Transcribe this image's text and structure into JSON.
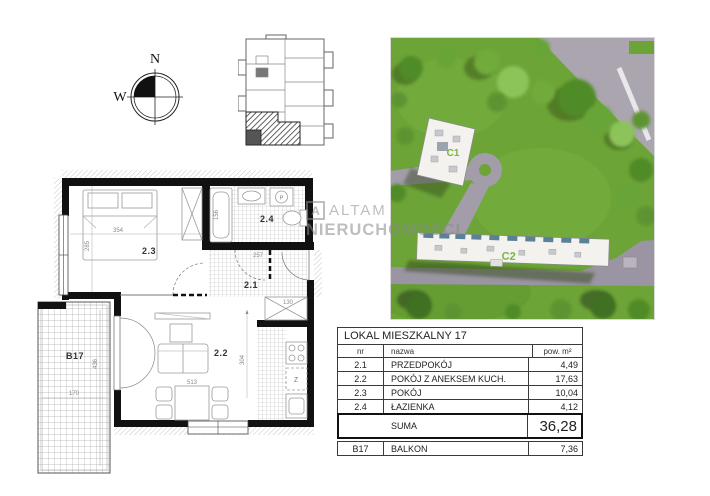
{
  "compass": {
    "north_label": "N",
    "west_label": "W"
  },
  "watermark": {
    "logo_letter": "A",
    "line1": "ALTAM",
    "line2": "NIERUCHOMOŚCI"
  },
  "site_photo": {
    "building1_label": "C1",
    "building2_label": "C2"
  },
  "floor_plan": {
    "rooms": {
      "hall": "2.1",
      "living": "2.2",
      "bedroom": "2.3",
      "bath": "2.4",
      "balcony": "B17"
    },
    "appliance_fridge_label": "Z",
    "washer_label": "P",
    "dimensions": {
      "bedroom_w": "354",
      "bedroom_h": "285",
      "tub_l": "156",
      "hall_w": "257",
      "closet_w": "130",
      "living_w": "513",
      "living_h": "304",
      "balcony_w": "170",
      "balcony_h": "436"
    }
  },
  "area_table": {
    "title": "LOKAL MIESZKALNY 17",
    "columns": {
      "nr": "nr",
      "name": "nazwa",
      "area": "pow. m²"
    },
    "rows": [
      {
        "nr": "2.1",
        "name": "PRZEDPOKÓJ",
        "area": "4,49"
      },
      {
        "nr": "2.2",
        "name": "POKÓJ Z ANEKSEM KUCH.",
        "area": "17,63"
      },
      {
        "nr": "2.3",
        "name": "POKÓJ",
        "area": "10,04"
      },
      {
        "nr": "2.4",
        "name": "ŁAZIENKA",
        "area": "4,12"
      }
    ],
    "suma_label": "SUMA",
    "suma_value": "36,28",
    "balkon_row": {
      "nr": "B17",
      "name": "BALKON",
      "area": "7,36"
    }
  }
}
